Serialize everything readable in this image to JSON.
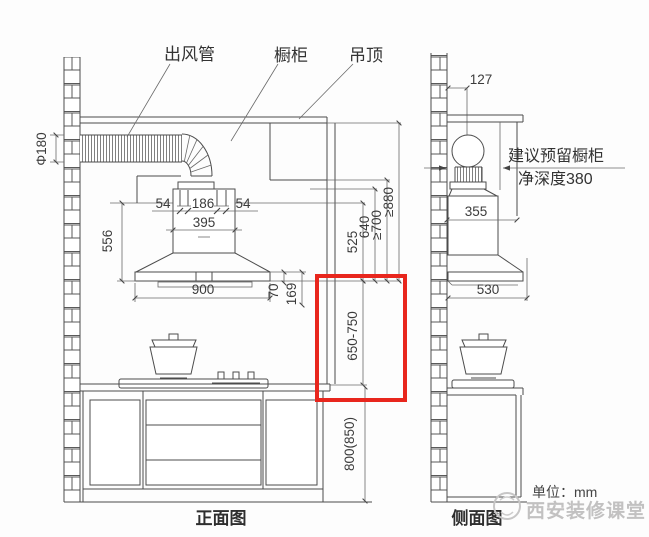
{
  "front": {
    "caption": "正面图",
    "callout_duct": "出风管",
    "callout_cabinet": "橱柜",
    "callout_ceiling": "吊顶",
    "dim_duct_diameter": "Φ180",
    "dim_hole_left": "54",
    "dim_hole_center": "186",
    "dim_hole_right": "54",
    "dim_body_width": "395",
    "dim_body_height": "556",
    "dim_hood_width": "900",
    "dim_lip": "70",
    "dim_lip2": "169",
    "dim_h525": "525",
    "dim_h640": "640",
    "dim_h700": "≥700",
    "dim_h880": "≥880",
    "dim_hood_to_counter": "650-750",
    "dim_counter_height": "800(850)"
  },
  "side": {
    "caption": "侧面图",
    "dim_wall_offset": "127",
    "dim_cabinet_depth": "355",
    "dim_hood_depth": "530",
    "note_line1": "建议预留橱柜",
    "note_line2": "净深度380"
  },
  "footer": {
    "unit_note": "单位：mm",
    "watermark": "西安装修课堂"
  },
  "highlight": {
    "color": "#e8261d"
  }
}
